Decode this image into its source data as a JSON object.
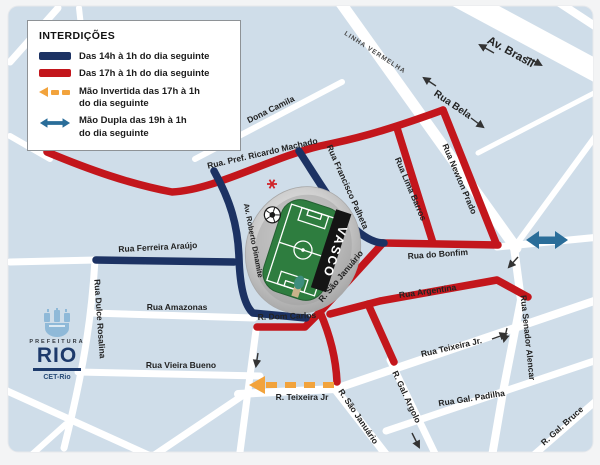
{
  "colors": {
    "navy": "#1c3263",
    "red": "#c3161c",
    "orange": "#f2a33c",
    "teal": "#2a6d99",
    "map_bg": "#cfdde9",
    "road": "#ffffff",
    "label": "#222222",
    "green": "#2e7d3f",
    "page_bg": "#f3f4f5",
    "legend_border": "#8e9296",
    "logo_navy": "#1d3a6b"
  },
  "legend": {
    "title": "INTERDIÇÕES",
    "items": [
      {
        "swatch": "navy-bar",
        "label": "Das 14h à 1h do dia seguinte"
      },
      {
        "swatch": "red-bar",
        "label": "Das 17h à 1h do dia seguinte"
      },
      {
        "swatch": "orange-dashed-arrow",
        "line1": "Mão Invertida das 17h à 1h",
        "line2": "do dia seguinte"
      },
      {
        "swatch": "teal-double-arrow",
        "line1": "Mão Dupla das 19h à 1h",
        "line2": "do dia seguinte"
      }
    ]
  },
  "map": {
    "street_labels": [
      {
        "name": "dona-camila",
        "text": "Dona Camila"
      },
      {
        "name": "linha-vermelha",
        "text": "LINHA VERMELHA"
      },
      {
        "name": "av-brasil",
        "text": "Av. Brasil"
      },
      {
        "name": "rua-bela",
        "text": "Rua Bela"
      },
      {
        "name": "ricardo-machado",
        "text": "Rua. Pref. Ricardo Machado"
      },
      {
        "name": "francisco-palheta",
        "text": "Rua Francisco Palheta"
      },
      {
        "name": "lima-barros",
        "text": "Rua Lima Barros"
      },
      {
        "name": "newton-prado",
        "text": "Rua Newton Prado"
      },
      {
        "name": "rua-do-bonfim",
        "text": "Rua do Bonfim"
      },
      {
        "name": "ferreira-araujo",
        "text": "Rua Ferreira Araújo"
      },
      {
        "name": "roberto-dinamite",
        "text": "Av. Roberto Dinamite"
      },
      {
        "name": "sao-januario-ne",
        "text": "R. São Januário"
      },
      {
        "name": "dom-carlos",
        "text": "R. Dom Carlos"
      },
      {
        "name": "argentina",
        "text": "Rua Argentina"
      },
      {
        "name": "senador-alencar",
        "text": "Rua Senador Alencar"
      },
      {
        "name": "dulce-rosalina",
        "text": "Rua Dulce Rosalina"
      },
      {
        "name": "amazonas",
        "text": "Rua Amazonas"
      },
      {
        "name": "vieira-bueno",
        "text": "Rua Vieira Bueno"
      },
      {
        "name": "teixeira-jr-west",
        "text": "R. Teixeira Jr"
      },
      {
        "name": "sao-januario-south",
        "text": "R.  São Januário"
      },
      {
        "name": "gal-argolo",
        "text": "R. Gal. Argolo"
      },
      {
        "name": "teixeira-jr-east",
        "text": "Rua Teixeira Jr."
      },
      {
        "name": "gal-padilha",
        "text": "Rua Gal. Padilha"
      },
      {
        "name": "gal-bruce",
        "text": "R. Gal. Bruce"
      }
    ],
    "stadium": {
      "banner": "VASCO"
    }
  },
  "logo": {
    "prefeitura": "PREFEITURA",
    "rio": "RIO",
    "cet": "CET-Rio"
  }
}
